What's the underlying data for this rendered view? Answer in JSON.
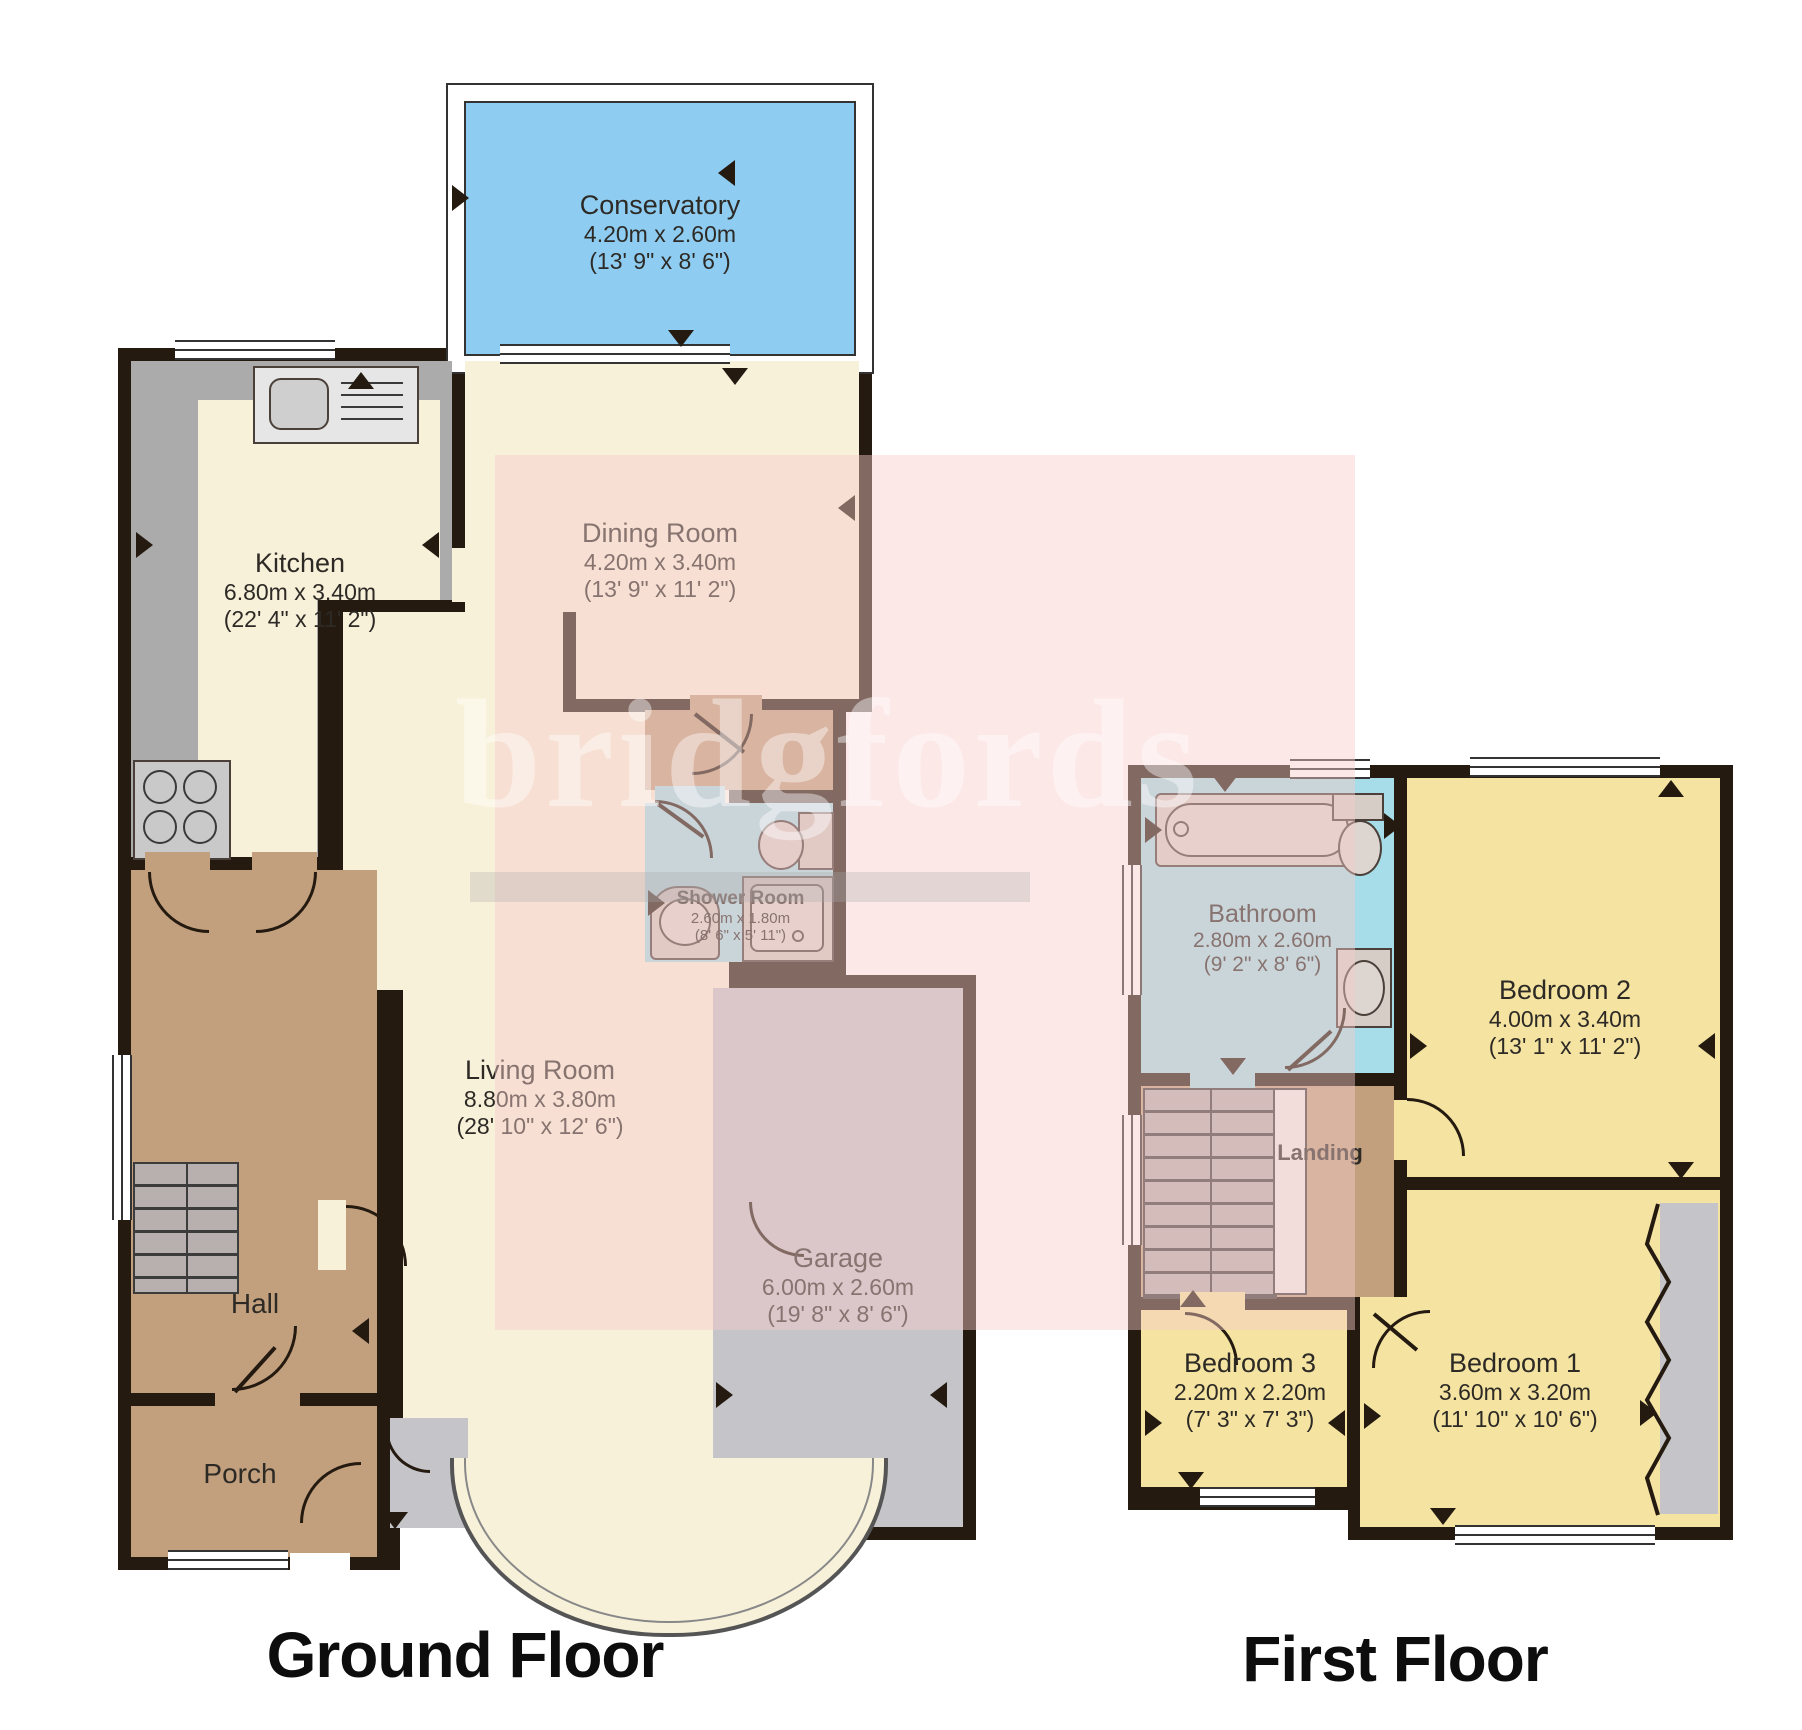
{
  "watermark": {
    "text": "bridgfords"
  },
  "floors": {
    "ground": {
      "title": "Ground Floor",
      "rooms": {
        "conservatory": {
          "name": "Conservatory",
          "metric": "4.20m x 2.60m",
          "imperial": "(13' 9\" x 8' 6\")"
        },
        "kitchen": {
          "name": "Kitchen",
          "metric": "6.80m x 3.40m",
          "imperial": "(22' 4\" x 11' 2\")"
        },
        "dining": {
          "name": "Dining Room",
          "metric": "4.20m x 3.40m",
          "imperial": "(13' 9\" x 11' 2\")"
        },
        "shower": {
          "name": "Shower Room",
          "metric": "2.60m x 1.80m",
          "imperial": "(8' 6\" x 5' 11\")"
        },
        "living": {
          "name": "Living Room",
          "metric": "8.80m x 3.80m",
          "imperial": "(28' 10\" x 12' 6\")"
        },
        "garage": {
          "name": "Garage",
          "metric": "6.00m x 2.60m",
          "imperial": "(19' 8\" x 8' 6\")"
        },
        "hall": {
          "name": "Hall"
        },
        "porch": {
          "name": "Porch"
        }
      }
    },
    "first": {
      "title": "First Floor",
      "rooms": {
        "bathroom": {
          "name": "Bathroom",
          "metric": "2.80m x 2.60m",
          "imperial": "(9' 2\" x 8' 6\")"
        },
        "bedroom2": {
          "name": "Bedroom 2",
          "metric": "4.00m x 3.40m",
          "imperial": "(13' 1\" x 11' 2\")"
        },
        "landing": {
          "name": "Landing"
        },
        "bedroom3": {
          "name": "Bedroom 3",
          "metric": "2.20m x 2.20m",
          "imperial": "(7' 3\" x 7' 3\")"
        },
        "bedroom1": {
          "name": "Bedroom 1",
          "metric": "3.60m x 3.20m",
          "imperial": "(11' 10\" x 10' 6\")"
        }
      }
    }
  },
  "colors": {
    "wall": "#241a10",
    "conservatory_blue": "#8ecdf1",
    "floor_cream": "#f8f1da",
    "hall_brown": "#c2a07e",
    "wet_room_cyan": "#a6dde8",
    "bedroom_yellow": "#f4e3a1",
    "garage_gray": "#c5c4c9",
    "counter_gray": "#ababab",
    "watermark_tint": "#f6cdc9"
  }
}
